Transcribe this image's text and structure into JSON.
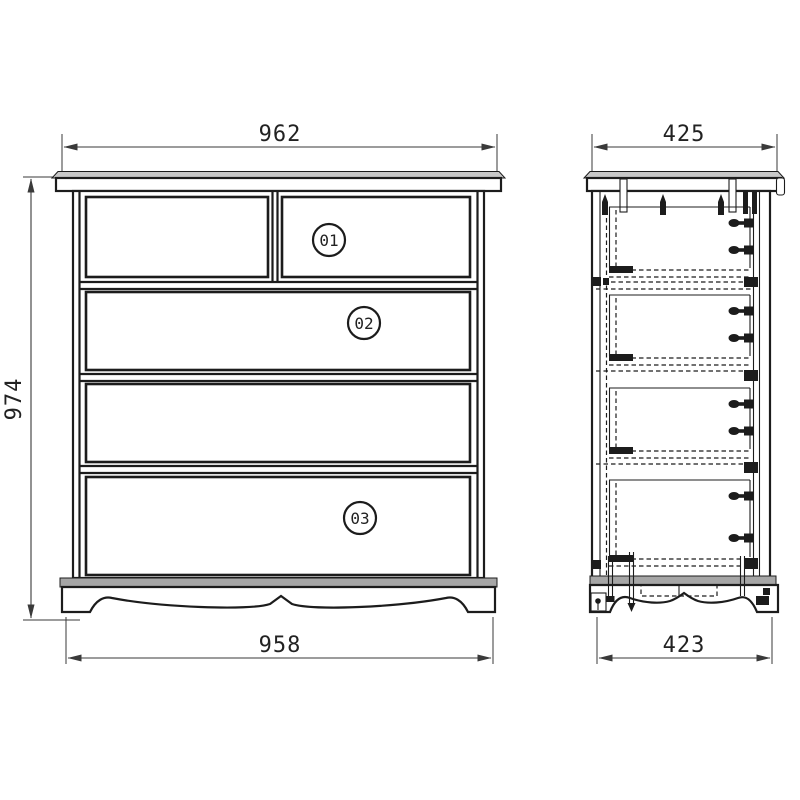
{
  "colors": {
    "background": "#ffffff",
    "line": "#1c1c1c",
    "top_board_shade": "#c8c8c8",
    "base_strip_shade": "#a6a6a6"
  },
  "front_view": {
    "dimensions": {
      "top_width": "962",
      "height": "974",
      "bottom_width": "958"
    },
    "drawer_labels": [
      "01",
      "02",
      "03"
    ]
  },
  "side_view": {
    "dimensions": {
      "top_width": "425",
      "bottom_width": "423"
    }
  }
}
